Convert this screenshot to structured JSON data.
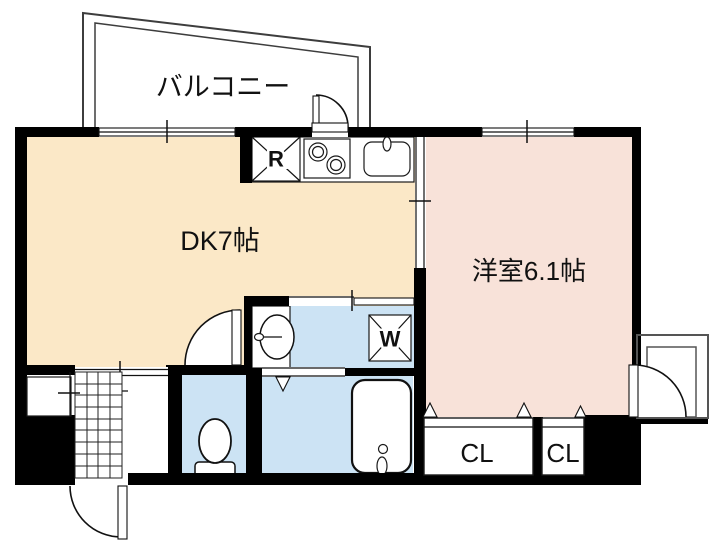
{
  "plan_type": "apartment-floor-plan",
  "rooms": {
    "balcony": {
      "label": "バルコニー"
    },
    "dining_kitchen": {
      "label": "DK7帖"
    },
    "western_room": {
      "label": "洋室6.1帖"
    },
    "closet_large": {
      "label": "CL"
    },
    "closet_small": {
      "label": "CL"
    }
  },
  "fixtures": {
    "refrigerator": {
      "label": "R"
    },
    "washing_machine": {
      "label": "W"
    }
  },
  "colors": {
    "dk_floor": "#FBE8C7",
    "western_room_floor": "#F8E2D9",
    "wet_area_floor": "#CCE3F4",
    "wall": "#000000"
  }
}
